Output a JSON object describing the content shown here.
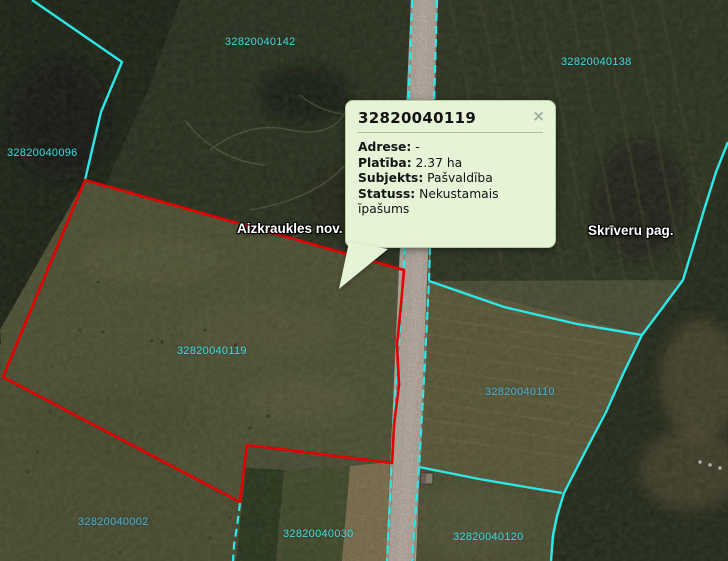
{
  "colors": {
    "boundary_cyan": "#2de8e8",
    "boundary_red": "#e40000",
    "parcel_label": "#3fdce2",
    "parcel_label_dark": "#4ab0d8",
    "place_label": "#ffffff",
    "road_fill": "#cabdb2",
    "popup_bg": "#e5f3d7",
    "popup_border": "#b9cda4",
    "popup_text": "#141414",
    "popup_divider": "#8fa086",
    "popup_close": "#9cab9a"
  },
  "map": {
    "place_labels": [
      {
        "text": "Aizkraukles nov.",
        "x": 237,
        "y": 221
      },
      {
        "text": "Skrīveru pag.",
        "x": 588,
        "y": 223
      }
    ],
    "parcel_labels": [
      {
        "text": "32820040142",
        "x": 225,
        "y": 36,
        "dark": false
      },
      {
        "text": "32820040138",
        "x": 561,
        "y": 56,
        "dark": false
      },
      {
        "text": "32820040096",
        "x": 7,
        "y": 147,
        "dark": false
      },
      {
        "text": "32820040119",
        "x": 177,
        "y": 345,
        "dark": false
      },
      {
        "text": "32820040110",
        "x": 485,
        "y": 386,
        "dark": true
      },
      {
        "text": "32820040002",
        "x": 78,
        "y": 516,
        "dark": true
      },
      {
        "text": "32820040030",
        "x": 283,
        "y": 528,
        "dark": false
      },
      {
        "text": "32820040120",
        "x": 453,
        "y": 531,
        "dark": false
      }
    ]
  },
  "popup": {
    "title": "32820040119",
    "close_label": "×",
    "fields": [
      {
        "label": "Adrese:",
        "value": "-"
      },
      {
        "label": "Platība:",
        "value": "2.37 ha"
      },
      {
        "label": "Subjekts:",
        "value": "Pašvaldība"
      },
      {
        "label": "Statuss:",
        "value": "Nekustamais īpašums"
      }
    ]
  }
}
